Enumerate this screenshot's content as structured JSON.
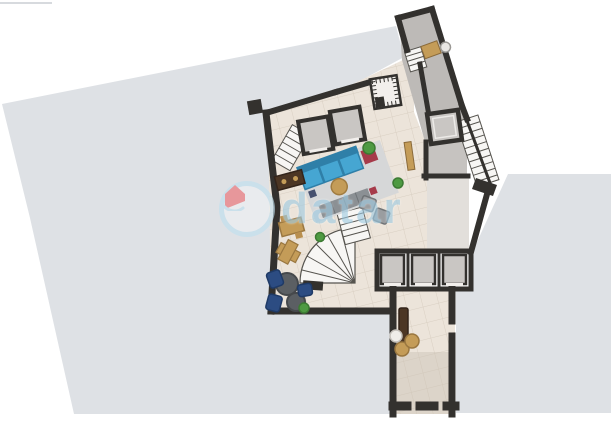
{
  "meta": {
    "kind": "real-estate floor plan render",
    "image_size": "611x432",
    "visible_text_other_than_watermark": "none"
  },
  "watermark": {
    "text": "datar",
    "logo": "house-icon",
    "ring_color": "#bfe0ef",
    "text_color": "#9fcbe2",
    "house_color": "#ee6a6f"
  },
  "colors": {
    "background": "#ffffff",
    "terrace": "#dee1e5",
    "wall": "#33312e",
    "tile": "#ece4da",
    "tile_line": "#d9cfc2",
    "corridor_gray": "#bdbab7",
    "landing_gray": "#c6c3c0",
    "side_room": "#e2dfdb",
    "elevator_fill": "#c9c6c3",
    "stair_white": "#f7f6f4",
    "stair_line": "#56544f",
    "rug": "#d6d7d8",
    "sofa_blue": "#46a6d2",
    "sofa_blue_dark": "#2f7fa8",
    "sectional_gray": "#8b9094",
    "navy_chair": "#2c4c82",
    "round_table_dark": "#5b5f63",
    "wood_tan": "#c49c58",
    "wood_dark": "#4c3624",
    "plant_green": "#4e9a42",
    "accent_red": "#a63a4a",
    "shadow_band": "#c9c0b4",
    "wmring": "#bfe0ef",
    "wmtext": "#9fcbe2",
    "wmhouse": "#ee6a6f"
  },
  "areas": [
    {
      "name": "left-terrace",
      "type": "outdoor terrace"
    },
    {
      "name": "right-terrace",
      "type": "outdoor terrace"
    },
    {
      "name": "main-hall",
      "type": "tiled lounge hall with sofa set and seating"
    },
    {
      "name": "upper-corridor",
      "type": "sloped corridor with reception desk"
    },
    {
      "name": "elevator-core",
      "type": "hatched shaft"
    },
    {
      "name": "elevator-bank-top",
      "type": "two elevators with stairs"
    },
    {
      "name": "elevator-bank-bottom",
      "type": "three elevators"
    },
    {
      "name": "bottom-corridor",
      "type": "tiled corridor with console and stools"
    },
    {
      "name": "staircase-right",
      "type": "straight stair"
    },
    {
      "name": "staircase-winder",
      "type": "curved stair"
    }
  ]
}
